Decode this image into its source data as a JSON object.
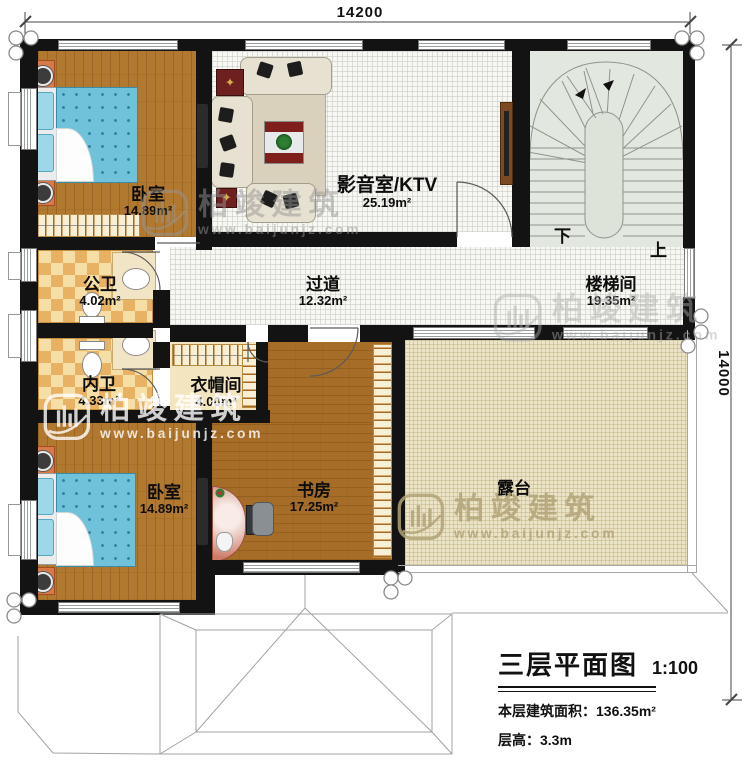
{
  "plan": {
    "dim_top": "14200",
    "dim_right": "14000",
    "stairs": {
      "down": "下",
      "up": "上"
    },
    "rooms": [
      {
        "id": "bedroom-top",
        "name": "卧室",
        "area": "14.89m²"
      },
      {
        "id": "media-room",
        "name": "影音室/KTV",
        "area": "25.19m²"
      },
      {
        "id": "stair-hall",
        "name": "楼梯间",
        "area": "19.35m²"
      },
      {
        "id": "hallway",
        "name": "过道",
        "area": "12.32m²"
      },
      {
        "id": "public-bath",
        "name": "公卫",
        "area": "4.02m²"
      },
      {
        "id": "ensuite-bath",
        "name": "内卫",
        "area": "4.33m²"
      },
      {
        "id": "cloakroom",
        "name": "衣帽间",
        "area": "4.00m²"
      },
      {
        "id": "bedroom-bottom",
        "name": "卧室",
        "area": "14.89m²"
      },
      {
        "id": "study",
        "name": "书房",
        "area": "17.25m²"
      },
      {
        "id": "terrace",
        "name": "露台",
        "area": ""
      }
    ],
    "title_block": {
      "title": "三层平面图",
      "scale": "1:100",
      "area_line": "本层建筑面积：136.35m²",
      "height_line": "层高：3.3m"
    },
    "watermark": {
      "brand": "柏竣建筑",
      "url": "www.baijunjz.com"
    },
    "colors": {
      "wall": "#131313",
      "wood": "#b1782f",
      "terrace": "#ece4c6",
      "stair": "#e2e7df",
      "bath_tile": "#e8b264",
      "quilt": "#6fc2da"
    }
  }
}
